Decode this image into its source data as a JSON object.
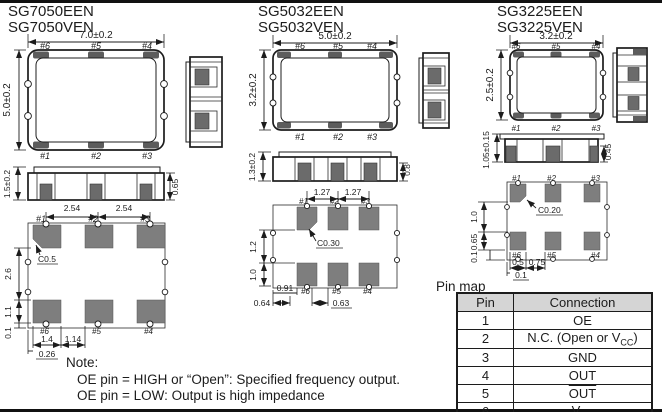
{
  "packages": {
    "sg7050": {
      "models": [
        "SG7050EEN",
        "SG7050VEN"
      ],
      "top": {
        "w": "7.0±0.2",
        "h": "5.0±0.2",
        "pt": [
          "#6",
          "#5",
          "#4"
        ],
        "pb": [
          "#1",
          "#2",
          "#3"
        ]
      },
      "front": {
        "h": "1.5±0.2",
        "ph": "0.65"
      },
      "land": {
        "pt": [
          "#1",
          "#2",
          "#3"
        ],
        "pb": [
          "#6",
          "#5",
          "#4"
        ],
        "pitch": [
          "2.54",
          "2.54"
        ],
        "chamfer": "C0.5",
        "left": [
          "2.6",
          "1.1",
          "0.1"
        ],
        "bottom": [
          "1.4",
          "1.14",
          "0.26"
        ]
      }
    },
    "sg5032": {
      "models": [
        "SG5032EEN",
        "SG5032VEN"
      ],
      "top": {
        "w": "5.0±0.2",
        "h": "3.2±0.2",
        "pt": [
          "#6",
          "#5",
          "#4"
        ],
        "pb": [
          "#1",
          "#2",
          "#3"
        ]
      },
      "front": {
        "h": "1.3±0.2",
        "ph": "0.8"
      },
      "land": {
        "pt": [
          "#1",
          "#2",
          "#3"
        ],
        "pb": [
          "#6",
          "#5",
          "#4"
        ],
        "pitch": [
          "1.27",
          "1.27"
        ],
        "chamfer": "C0.30",
        "left": [
          "1.2",
          "1.0"
        ],
        "bottom": [
          "0.91",
          "0.64",
          "0.63"
        ]
      }
    },
    "sg3225": {
      "models": [
        "SG3225EEN",
        "SG3225VEN"
      ],
      "top": {
        "w": "3.2±0.2",
        "h": "2.5±0.2",
        "pt": [
          "#6",
          "#5",
          "#4"
        ],
        "pb": [
          "#1",
          "#2",
          "#3"
        ]
      },
      "front": {
        "h": "1.05±0.15",
        "ph": "0.45"
      },
      "land": {
        "pt": [
          "#1",
          "#2",
          "#3"
        ],
        "pb": [
          "#6",
          "#5",
          "#4"
        ],
        "chamfer": "C0.20",
        "left": [
          "1.0",
          "0.65",
          "0.1"
        ],
        "bottom": [
          "0.5",
          "0.75",
          "0.1"
        ]
      }
    }
  },
  "pin_map": {
    "label": "Pin map",
    "headers": [
      "Pin",
      "Connection"
    ],
    "rows": [
      {
        "pin": "1",
        "connection": "OE"
      },
      {
        "pin": "2",
        "pre": "N.C. (Open or V",
        "sub": "CC",
        "post": ")"
      },
      {
        "pin": "3",
        "connection": "GND"
      },
      {
        "pin": "4",
        "connection": "OUT"
      },
      {
        "pin": "5",
        "connection": "OUT"
      },
      {
        "pin": "6",
        "pre": "V",
        "sub": "CC"
      }
    ]
  },
  "note": {
    "label": "Note:",
    "lines": [
      "OE pin = HIGH or “Open”: Specified frequency output.",
      "OE pin = LOW: Output is high impedance"
    ]
  }
}
